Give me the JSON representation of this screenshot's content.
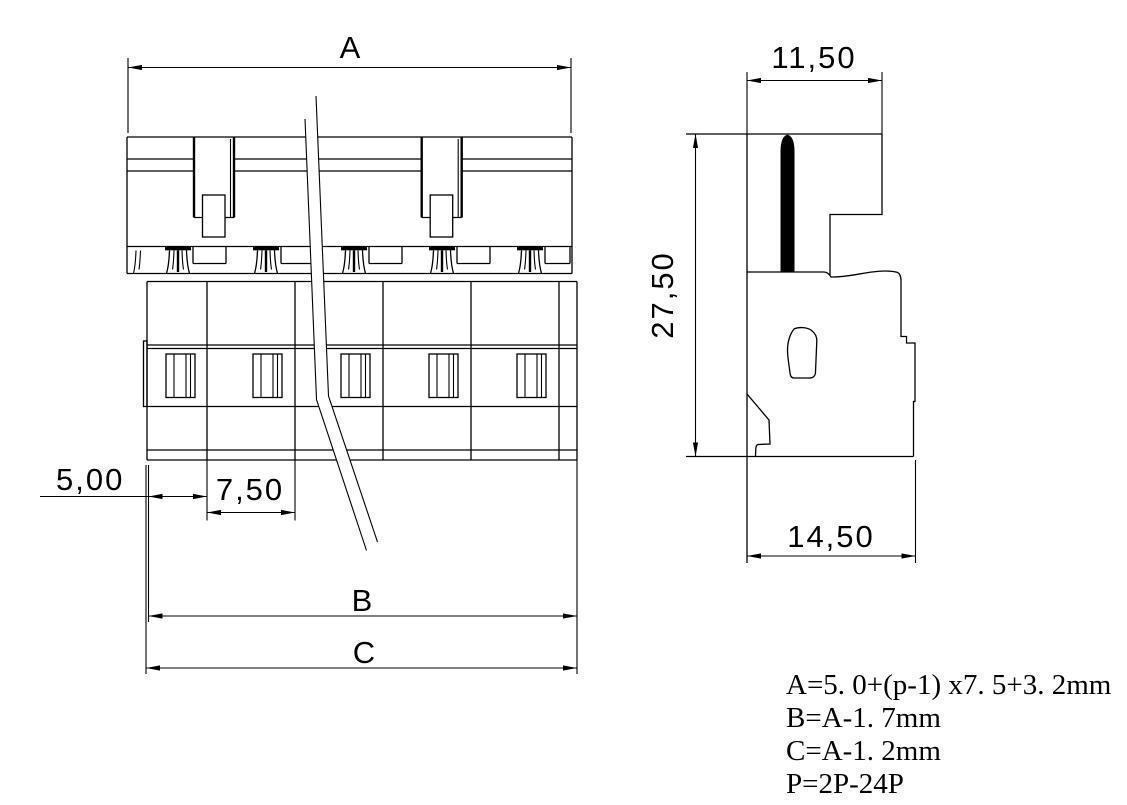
{
  "page": {
    "background": "#ffffff",
    "line_color": "#000000"
  },
  "front_view": {
    "dim_a": "A",
    "dim_b": "B",
    "dim_c": "C",
    "dim_end_pocket": "5,00",
    "dim_pitch": "7,50"
  },
  "side_view": {
    "dim_top_width": "11,50",
    "dim_height": "27,50",
    "dim_bottom_depth": "14,50"
  },
  "formulas": {
    "line_a": "A=5. 0+(p-1) x7. 5+3. 2mm",
    "line_b": "B=A-1. 7mm",
    "line_c": "C=A-1. 2mm",
    "line_p": "P=2P-24P"
  }
}
